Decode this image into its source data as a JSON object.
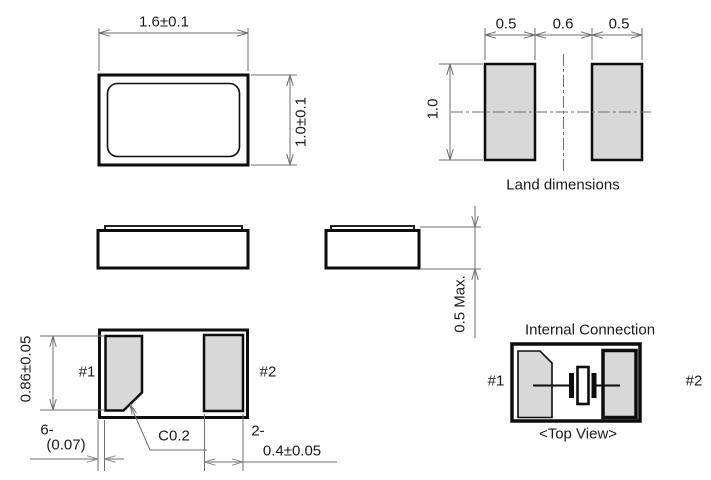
{
  "drawing": {
    "top_view": {
      "body_width_dim": "1.6±0.1",
      "body_height_dim": "1.0±0.1"
    },
    "land_pattern": {
      "left_pad_width_dim": "0.5",
      "gap_dim": "0.6",
      "right_pad_width_dim": "0.5",
      "pad_height_dim": "1.0",
      "caption": "Land dimensions"
    },
    "side_view": {
      "max_height_dim": "0.5 Max."
    },
    "bottom_view": {
      "pad_height_dim": "0.86±0.05",
      "pad1_label": "#1",
      "pad2_label": "#2",
      "clearance_qty": "6-",
      "clearance_dim": "(0.07)",
      "chamfer_dim": "C0.2",
      "pad_width_qty": "2-",
      "pad_width_dim": "0.4±0.05"
    },
    "internal_connection": {
      "title": "Internal Connection",
      "pad1_label": "#1",
      "pad2_label": "#2",
      "caption": "<Top View>"
    }
  },
  "colors": {
    "outline": "#0d0d0d",
    "pad_fill": "#d8d8d8",
    "dimension_line": "#6e6e6e",
    "text": "#1a1a1a"
  }
}
